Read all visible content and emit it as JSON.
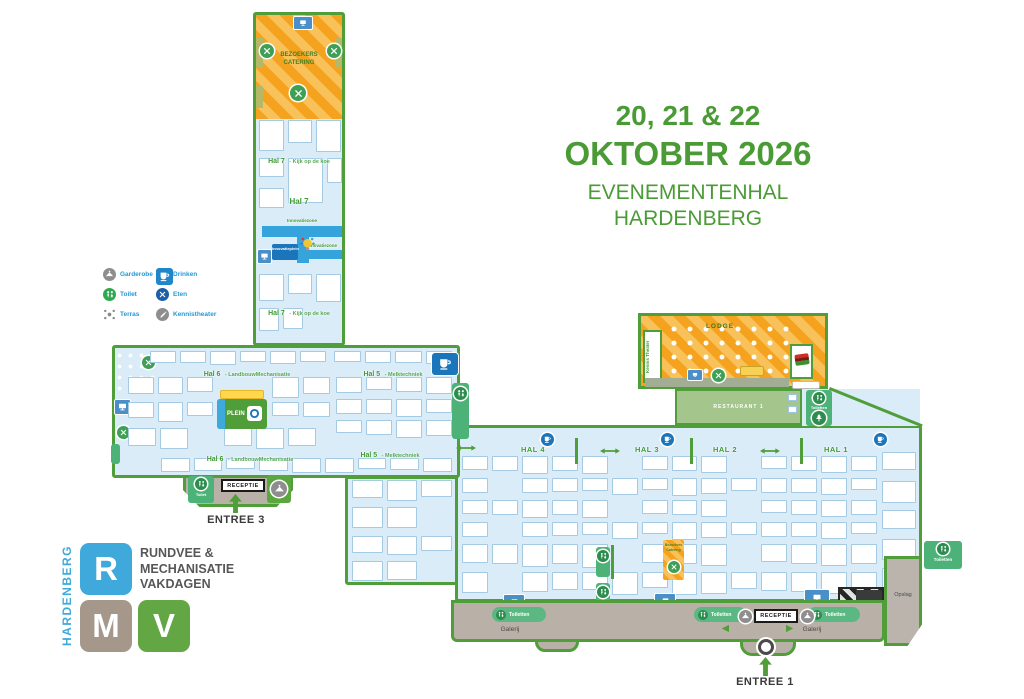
{
  "title": {
    "dates": "20, 21 & 22",
    "monthYear": "OKTOBER 2026",
    "venue1": "EVENEMENTENHAL",
    "venue2": "HARDENBERG"
  },
  "legend": {
    "garderobe": "Garderobe",
    "toilet": "Toilet",
    "terras": "Terras",
    "drinken": "Drinken",
    "eten": "Eten",
    "kennistheater": "Kennistheater"
  },
  "halls": {
    "hal7name": "Hal 7",
    "hal7suffix": "- Kijk op de koe",
    "hal6name": "Hal 6",
    "hal6suffix": "- LandbouwMechanisatie",
    "hal5name": "Hal 5",
    "hal5suffix": "- Melktechniek",
    "hal4": "HAL 4",
    "hal3": "HAL 3",
    "hal2": "HAL 2",
    "hal1": "HAL 1"
  },
  "areas": {
    "bezoekersCatering": "BEZOEKERS CATERING",
    "bezoekersCateringSmall": "Bezoekers Catering",
    "lodge": "LODGE",
    "kennisTheaterRoom": "Kennis Theater",
    "restaurant": "RESTAURANT 1",
    "plein": "PLEIN",
    "innovatiezone": "Innovatiezone",
    "innovatieplein": "Innovatieplein",
    "opslag": "Opslag",
    "galerij": "Galerij",
    "toiletten": "Toiletten",
    "toilet": "Toilet",
    "receptie": "RECEPTIE"
  },
  "entrances": {
    "entree1": "ENTREE 1",
    "entree3": "ENTREE 3"
  },
  "logo": {
    "city": "HARDENBERG",
    "r": "R",
    "m": "M",
    "v": "V",
    "line1": "RUNDVEE &",
    "line2": "MECHANISATIE",
    "line3": "VAKDAGEN"
  },
  "colors": {
    "mapGreen": "#4f9e3a",
    "hallBlue": "#d9ecf7",
    "orange": "#f5a31f",
    "toiletGreen": "#4db278",
    "infoBlue": "#1f9ad6",
    "titleGreen": "#4a9b35",
    "galerijGray": "#b9b0a8"
  }
}
